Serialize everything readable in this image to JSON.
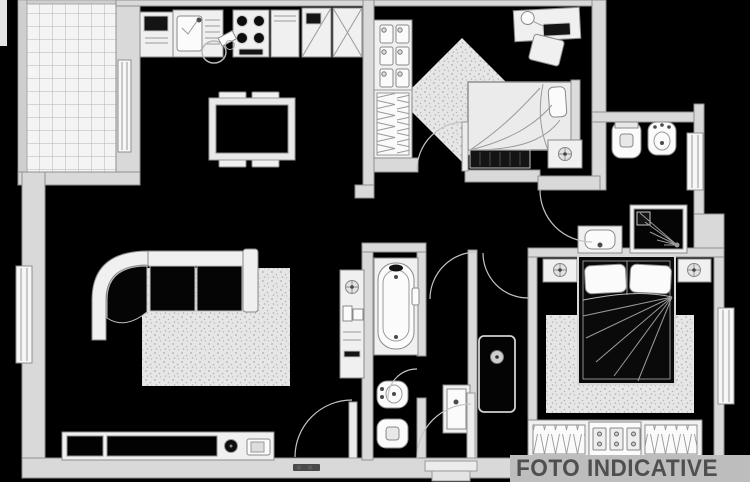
{
  "watermark": {
    "label": "FOTO INDICATIVE",
    "text_color": "#4f4f4f",
    "band_color": "#bdbdbd"
  },
  "palette": {
    "background": "#000000",
    "wall_fill": "#d9d9d9",
    "wall_outline": "#8f8f8f",
    "furniture_fill": "#f0f0f0",
    "furniture_outline": "#8a8a8a",
    "fixture_dark": "#141414",
    "rug_fill": "#e6e6e6",
    "tile_line": "#b4b4b4",
    "window_fill": "#f7f7f7"
  },
  "symbols": [
    "terrace-tiles",
    "kitchen-sink",
    "cooktop",
    "kitchen-cabinets",
    "dining-table",
    "dining-chairs",
    "stool",
    "corner-sofa",
    "area-rug",
    "sideboard",
    "shoe-wardrobe",
    "hanging-wardrobe",
    "single-bed",
    "double-bed",
    "desk",
    "desk-lamp",
    "desk-chair",
    "bench",
    "nightstand",
    "plant",
    "bathtub",
    "toilet",
    "bidet",
    "shower",
    "washbasin",
    "door-swing",
    "window",
    "entrance-steps"
  ]
}
